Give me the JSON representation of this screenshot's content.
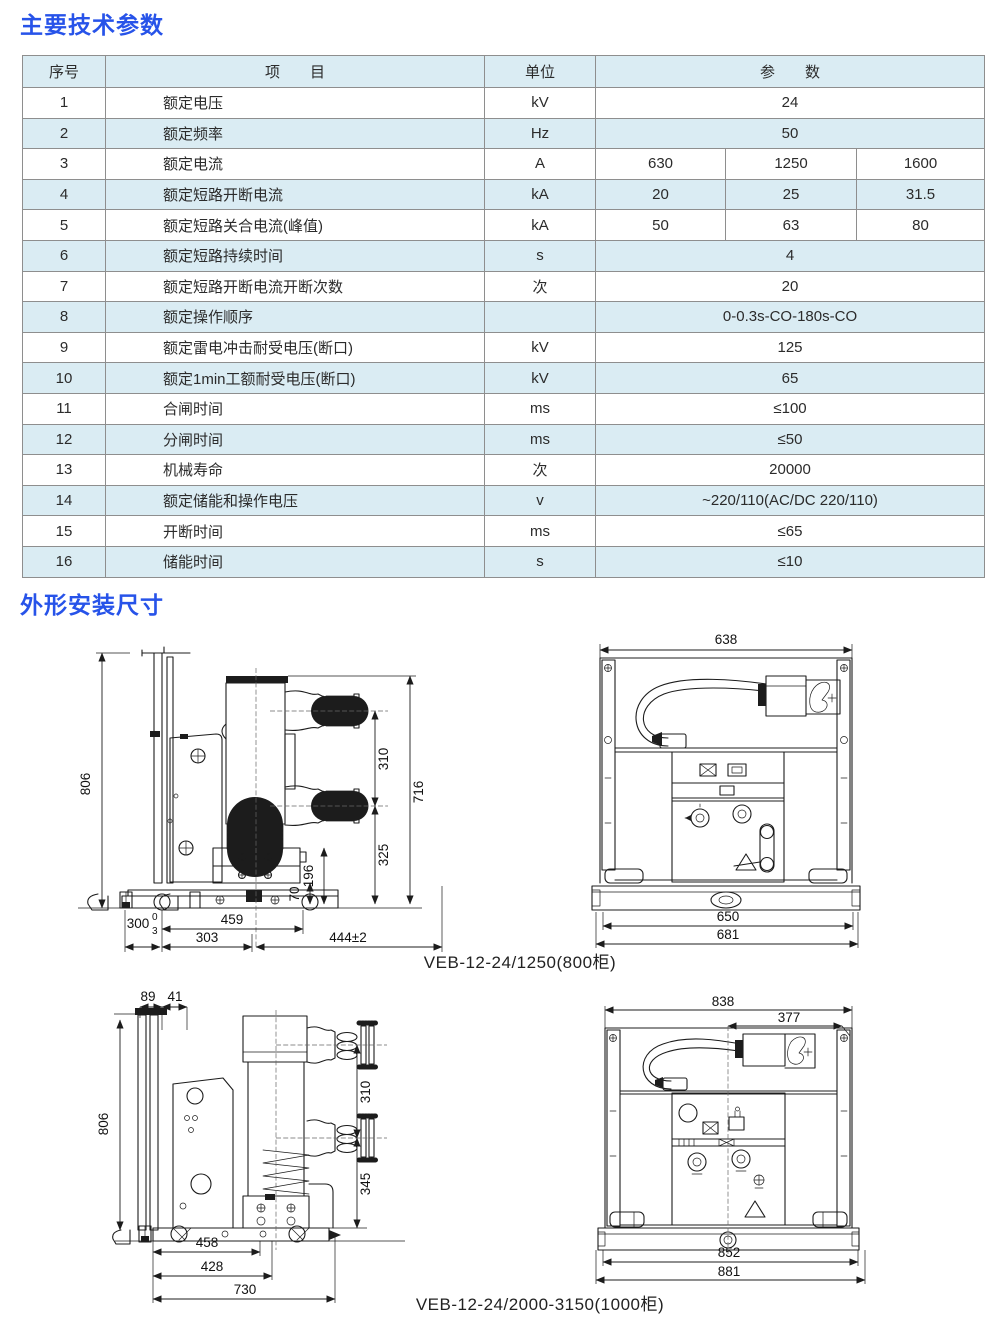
{
  "sections": {
    "s1": "主要技术参数",
    "s2": "外形安装尺寸"
  },
  "table": {
    "headers": {
      "no": "序号",
      "item": "项　　目",
      "unit": "单位",
      "param": "参　　数"
    },
    "rows": [
      {
        "no": "1",
        "item": "额定电压",
        "unit": "kV",
        "values": [
          "24"
        ]
      },
      {
        "no": "2",
        "item": "额定频率",
        "unit": "Hz",
        "values": [
          "50"
        ]
      },
      {
        "no": "3",
        "item": "额定电流",
        "unit": "A",
        "values": [
          "630",
          "1250",
          "1600"
        ]
      },
      {
        "no": "4",
        "item": "额定短路开断电流",
        "unit": "kA",
        "values": [
          "20",
          "25",
          "31.5"
        ]
      },
      {
        "no": "5",
        "item": "额定短路关合电流(峰值)",
        "unit": "kA",
        "values": [
          "50",
          "63",
          "80"
        ]
      },
      {
        "no": "6",
        "item": "额定短路持续时间",
        "unit": "s",
        "values": [
          "4"
        ]
      },
      {
        "no": "7",
        "item": "额定短路开断电流开断次数",
        "unit": "次",
        "values": [
          "20"
        ]
      },
      {
        "no": "8",
        "item": "额定操作顺序",
        "unit": "",
        "values": [
          "0-0.3s-CO-180s-CO"
        ]
      },
      {
        "no": "9",
        "item": "额定雷电冲击耐受电压(断口)",
        "unit": "kV",
        "values": [
          "125"
        ]
      },
      {
        "no": "10",
        "item": "额定1min工额耐受电压(断口)",
        "unit": "kV",
        "values": [
          "65"
        ]
      },
      {
        "no": "11",
        "item": "合闸时间",
        "unit": "ms",
        "values": [
          "≤100"
        ]
      },
      {
        "no": "12",
        "item": "分闸时间",
        "unit": "ms",
        "values": [
          "≤50"
        ]
      },
      {
        "no": "13",
        "item": "机械寿命",
        "unit": "次",
        "values": [
          "20000"
        ]
      },
      {
        "no": "14",
        "item": "额定储能和操作电压",
        "unit": "v",
        "values": [
          "~220/110(AC/DC 220/110)"
        ]
      },
      {
        "no": "15",
        "item": "开断时间",
        "unit": "ms",
        "values": [
          "≤65"
        ]
      },
      {
        "no": "16",
        "item": "储能时间",
        "unit": "s",
        "values": [
          "≤10"
        ]
      }
    ]
  },
  "drawings": {
    "caption1": "VEB-12-24/1250(800柜)",
    "caption2": "VEB-12-24/2000-3150(1000柜)",
    "d1": {
      "h_total": "806",
      "v_gap": "310",
      "v_overall": "716",
      "v_lower": "325",
      "v_box": "196",
      "v_base": "70",
      "w_rail": "459",
      "w_left": "303",
      "w_depth": "444±2",
      "w_small": "300",
      "tol_top": "0",
      "tol_bot": "3"
    },
    "d2": {
      "w_top": "638",
      "w_inner": "650",
      "w_outer": "681"
    },
    "d3": {
      "w_a": "89",
      "w_b": "41",
      "h_total": "806",
      "v_gap": "310",
      "v_lower": "345",
      "w_rail": "458",
      "w_mid": "428",
      "w_overall": "730"
    },
    "d4": {
      "w_top": "838",
      "w_offset": "377",
      "w_inner": "852",
      "w_outer": "881"
    }
  },
  "colors": {
    "accent": "#2753e9",
    "row_alt": "#daecf3",
    "line": "#1c1c1c"
  }
}
